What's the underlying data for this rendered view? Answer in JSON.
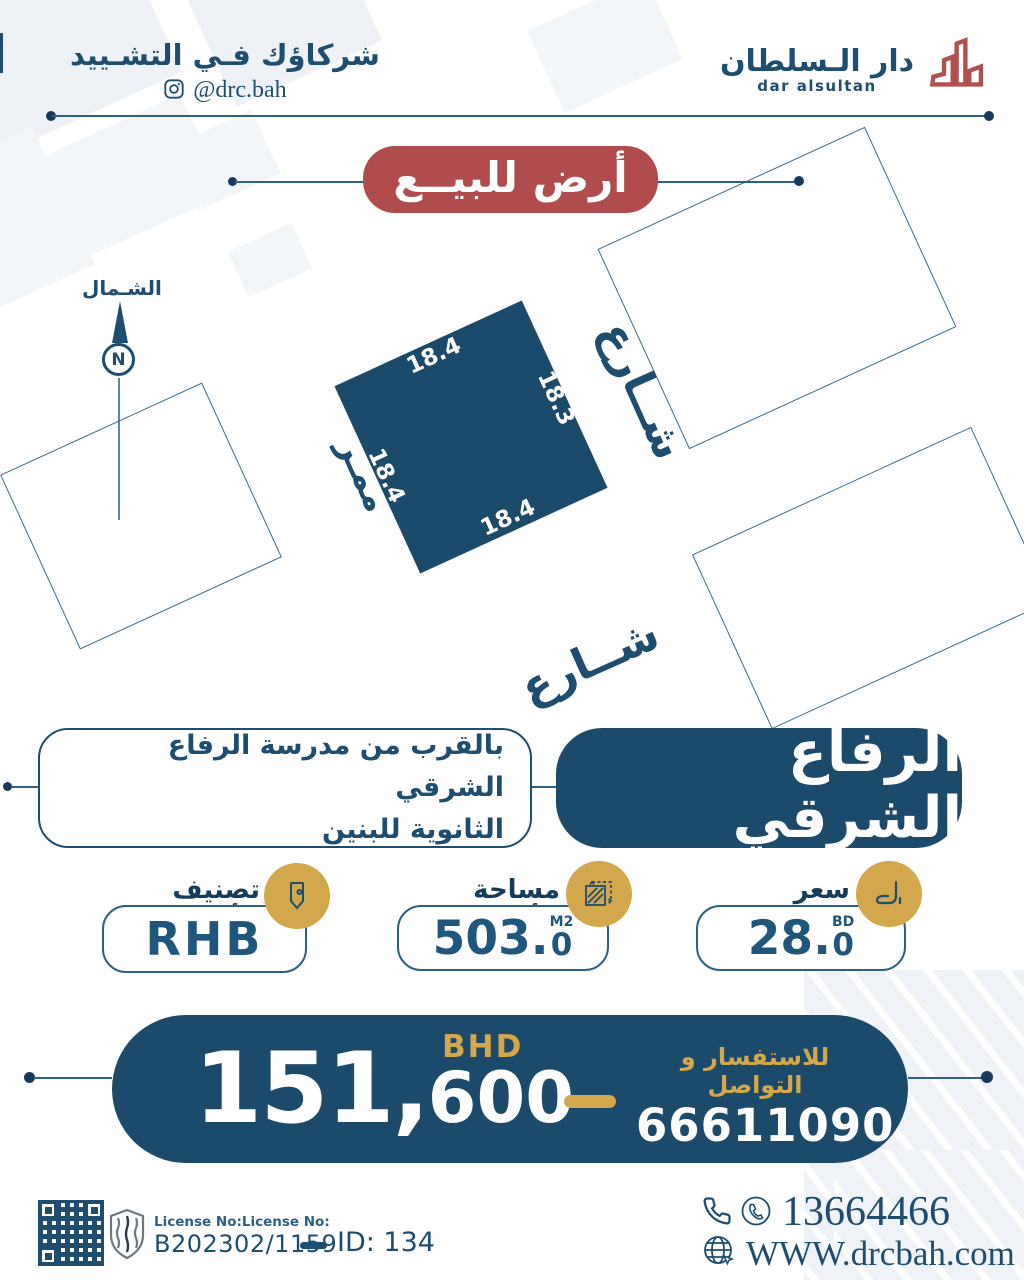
{
  "header": {
    "tagline": "شركاؤك فـي التشـييد",
    "instagram_handle": "@drc.bah",
    "brand_ar": "دار الـسلطان",
    "brand_en": "dar alsultan"
  },
  "badge": {
    "label": "أرض للبيــع"
  },
  "site_plan": {
    "north_label": "الشـمال",
    "compass_letter": "N",
    "street_right": "شــارع",
    "street_bottom": "شــارع",
    "passage": "ممـر",
    "dims": {
      "top": "18.4",
      "right": "18.3",
      "bottom": "18.4",
      "left": "18.4"
    }
  },
  "location": {
    "name": "الرفاع الشرقي",
    "description_line1": "بالقرب من مدرسة الرفاع الشرقي",
    "description_line2": "الثانوية للبنين"
  },
  "cards": {
    "price_per_foot": {
      "label": "سعر القدم",
      "value_main": "28.",
      "value_dec": "0",
      "unit": "BD"
    },
    "area": {
      "label": "مساحة الأرض",
      "value_main": "503.",
      "value_dec": "0",
      "unit": "M2"
    },
    "classification": {
      "label": "تصنيف الأرض",
      "value": "RHB"
    }
  },
  "price": {
    "amount_main": "151,",
    "amount_rest": "600",
    "currency": "BHD",
    "contact_label": "للاستفسار و التواصل",
    "contact_number": "66611090"
  },
  "footer": {
    "license_label": "License No:License No:",
    "license_number": "B202302/1159",
    "listing_id": "ID: 134",
    "phone": "13664466",
    "website": "WWW.drcbah.com"
  },
  "colors": {
    "navy": "#1c4a6a",
    "red": "#b04c4c",
    "gold": "#d3a74b",
    "line": "#2d6186"
  }
}
